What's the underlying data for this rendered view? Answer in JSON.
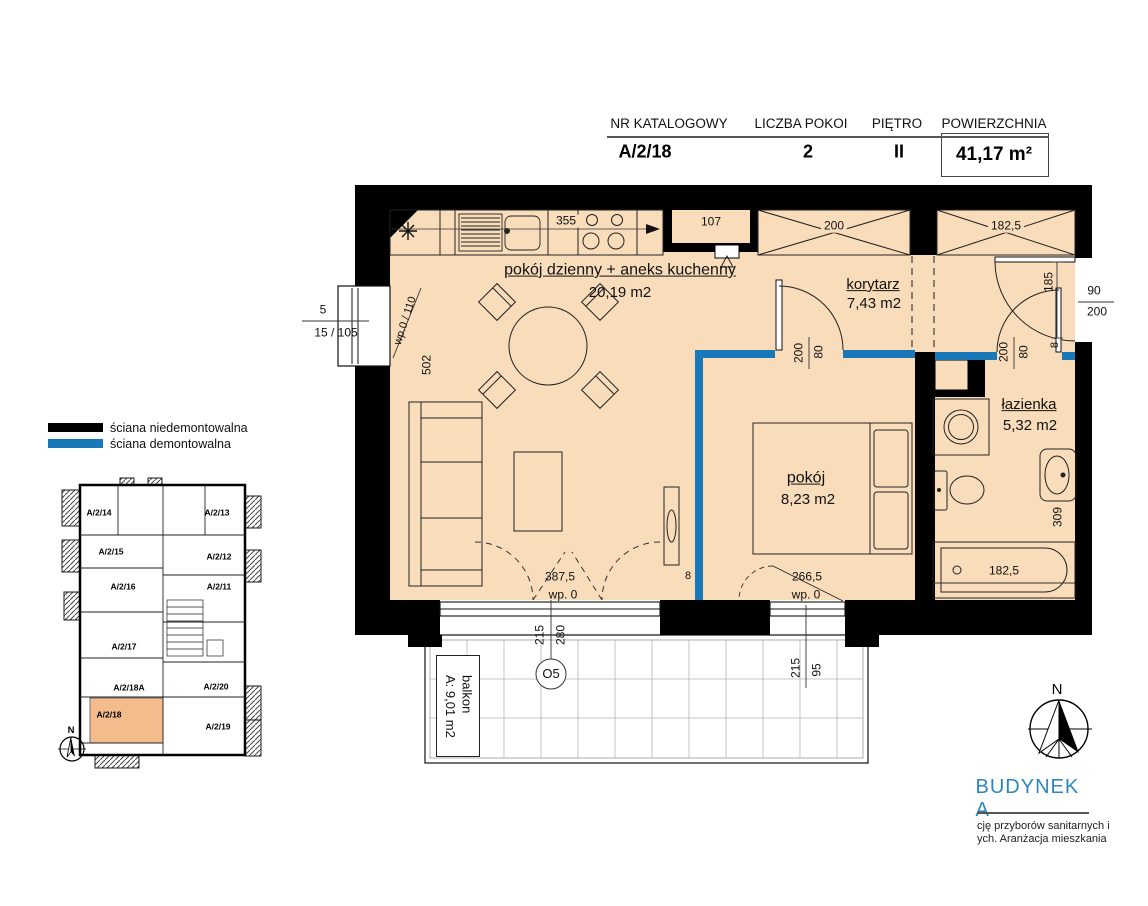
{
  "header": {
    "col_catalog": {
      "label": "NR KATALOGOWY",
      "value": "A/2/18"
    },
    "col_rooms": {
      "label": "LICZBA POKOI",
      "value": "2"
    },
    "col_floor": {
      "label": "PIĘTRO",
      "value": "II"
    },
    "col_area": {
      "label": "POWIERZCHNIA",
      "value": "41,17 m²"
    }
  },
  "legend": {
    "non_demountable": "ściana niedemontowalna",
    "demountable": "ściana demontowalna"
  },
  "plan": {
    "rooms": {
      "living": {
        "name": "pokój dzienny + aneks kuchenny",
        "area": "20,19 m2"
      },
      "corridor": {
        "name": "korytarz",
        "area": "7,43 m2"
      },
      "bedroom": {
        "name": "pokój",
        "area": "8,23 m2"
      },
      "bathroom": {
        "name": "łazienka",
        "area": "5,32 m2"
      },
      "balcony": {
        "name": "balkon",
        "area": "A: 9,01 m2"
      }
    },
    "dims": {
      "counter": "355",
      "niche": "107",
      "wardrobe_a": "200",
      "wardrobe_b": "182,5",
      "entry_inside": "185",
      "entry_w": "90",
      "entry_h": "200",
      "door_w": "80",
      "door_h": "200",
      "wall8": "8",
      "living_w": "387,5",
      "living_h": "502",
      "bedroom_w": "266,5",
      "wp0": "wp. 0",
      "tub_w": "182,5",
      "bath_h": "309",
      "win_o5": {
        "w": "280",
        "h": "215",
        "tag": "O5"
      },
      "win_bed": {
        "w": "95",
        "h": "215"
      },
      "left_win": "wp.0 / 110",
      "cut_a": "5",
      "cut_b": "15 / 105"
    }
  },
  "overview": {
    "units": [
      "A/2/14",
      "A/2/13",
      "A/2/15",
      "A/2/12",
      "A/2/16",
      "A/2/11",
      "A/2/17",
      "A/2/18A",
      "A/2/20",
      "A/2/18",
      "A/2/19"
    ],
    "highlighted_unit": "A/2/18",
    "north": "N"
  },
  "footer": {
    "building": "BUDYNEK A",
    "note1": "cję przyborów sanitarnych i",
    "note2": "ych. Aranżacja mieszkania",
    "north": "N"
  },
  "colors": {
    "wall": "#000000",
    "demountable_wall": "#1878b8",
    "floor": "#f9dcba",
    "highlight_unit": "#f2bc8c",
    "brand_blue": "#2e86c1"
  }
}
